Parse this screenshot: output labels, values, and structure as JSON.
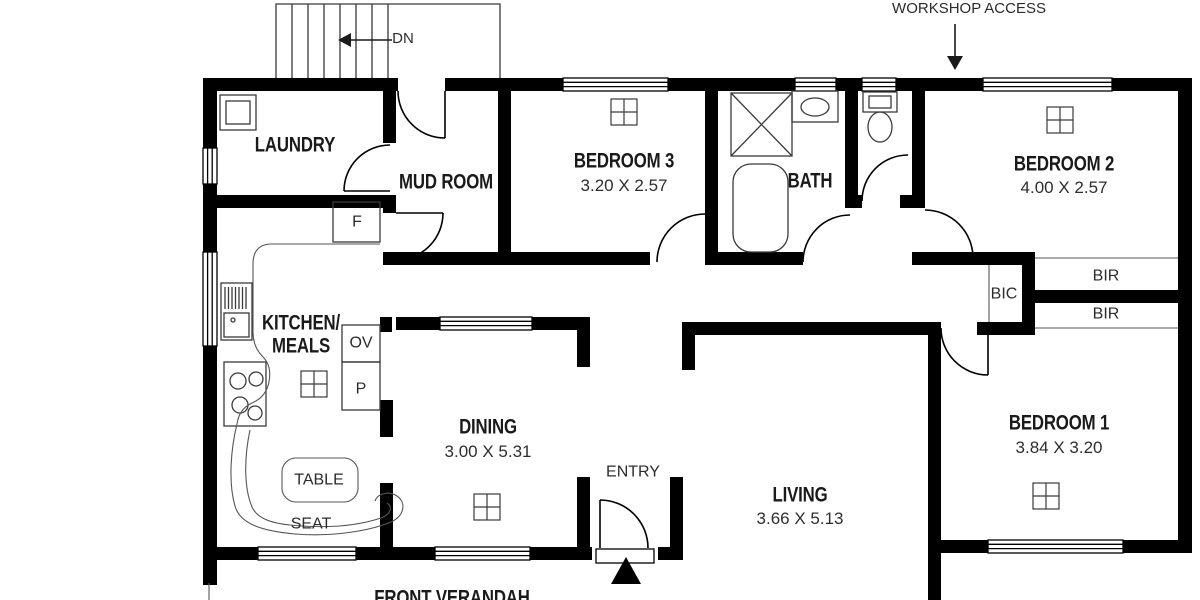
{
  "plan": {
    "annotations": {
      "workshop_access": "WORKSHOP ACCESS",
      "down": "DN",
      "front_verandah": "FRONT VERANDAH",
      "entry": "ENTRY"
    },
    "rooms": {
      "laundry": {
        "name": "LAUNDRY"
      },
      "mud_room": {
        "name": "MUD ROOM"
      },
      "bedroom_3": {
        "name": "BEDROOM 3",
        "dimensions": "3.20 X 2.57"
      },
      "bath": {
        "name": "BATH"
      },
      "bedroom_2": {
        "name": "BEDROOM 2",
        "dimensions": "4.00 X 2.57"
      },
      "kitchen_meals": {
        "name_line_1": "KITCHEN/",
        "name_line_2": "MEALS"
      },
      "dining": {
        "name": "DINING",
        "dimensions": "3.00 X 5.31"
      },
      "living": {
        "name": "LIVING",
        "dimensions": "3.66 X 5.13"
      },
      "bedroom_1": {
        "name": "BEDROOM 1",
        "dimensions": "3.84 X 3.20"
      }
    },
    "storage": {
      "bic": "BIC",
      "bir_1": "BIR",
      "bir_2": "BIR"
    },
    "fixtures": {
      "fridge": "F",
      "oven": "OV",
      "pantry": "P",
      "table": "TABLE",
      "seat": "SEAT"
    },
    "colors": {
      "wall": "#000000",
      "fixture_line": "#3a3a3a",
      "background": "#ffffff",
      "text": "#1a1a1a"
    }
  }
}
